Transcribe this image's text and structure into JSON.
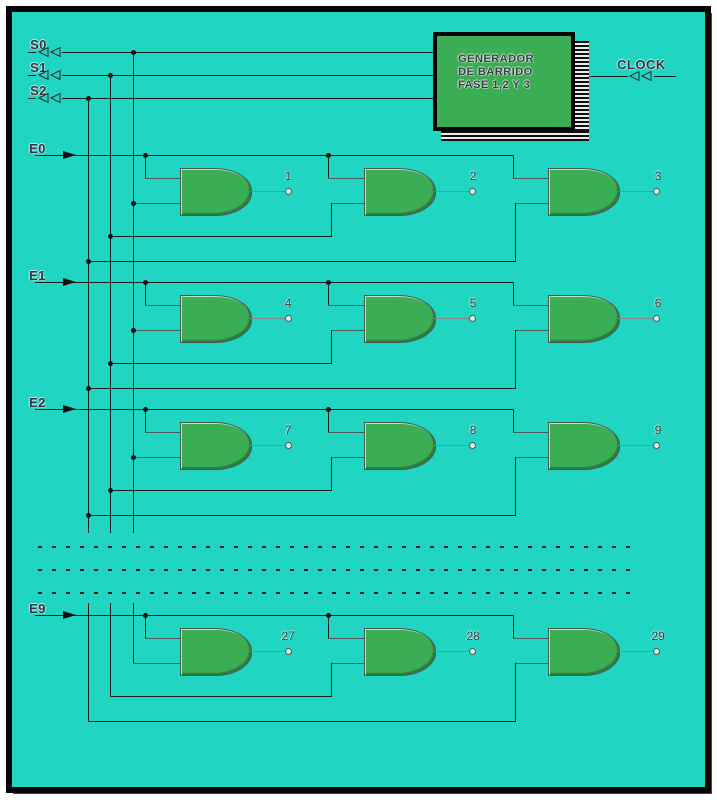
{
  "colors": {
    "background": "#21d5c3",
    "block_green": "#3bad55",
    "wire": "#1d1d1d",
    "text": "#333340"
  },
  "generator": {
    "line1": "GENERADOR",
    "line2": "DE BARRIDO",
    "line3": "FASE  1,2 Y 3"
  },
  "clock_label": "CLOCK",
  "phases": {
    "s0": "S0",
    "s1": "S1",
    "s2": "S2"
  },
  "rows": [
    {
      "label": "E0",
      "g1": "1",
      "g2": "2",
      "g3": "3"
    },
    {
      "label": "E1",
      "g1": "4",
      "g2": "5",
      "g3": "6"
    },
    {
      "label": "E2",
      "g1": "7",
      "g2": "8",
      "g3": "9"
    },
    {
      "label": "E9",
      "g1": "27",
      "g2": "28",
      "g3": "29"
    }
  ]
}
